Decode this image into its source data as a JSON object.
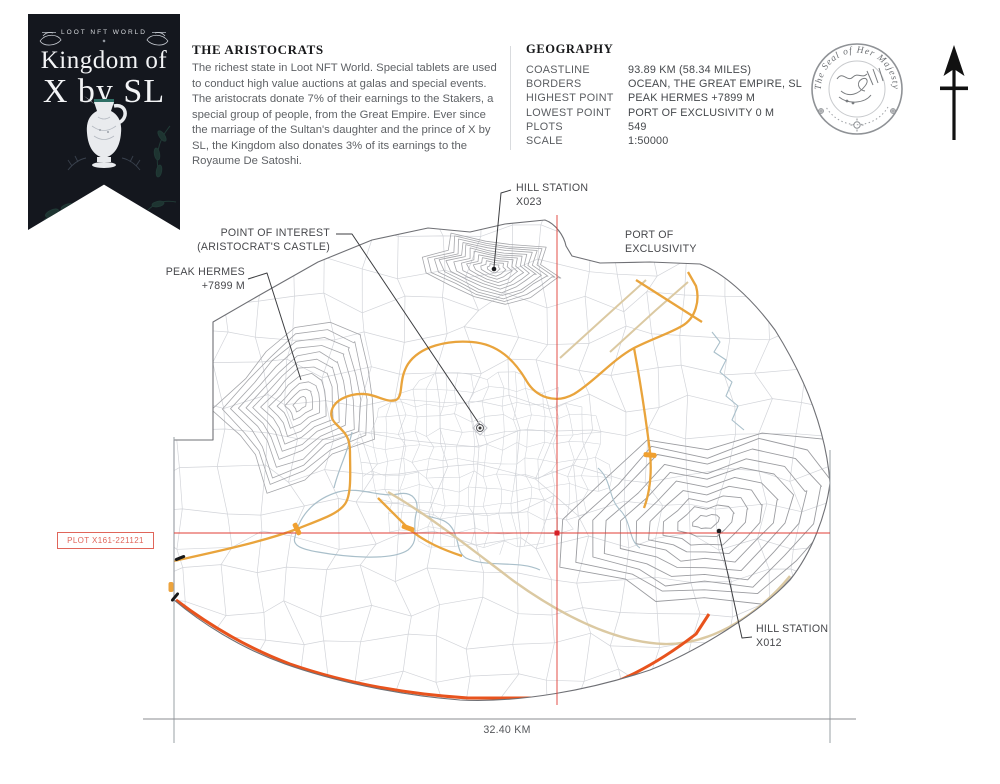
{
  "banner": {
    "kicker": "LOOT NFT WORLD",
    "title_line1": "Kingdom of",
    "title_line2": "X by SL"
  },
  "about": {
    "heading": "THE ARISTOCRATS",
    "body": "The richest state in Loot NFT World. Special tablets are used to conduct high value auctions at galas and special events. The aristocrats donate 7% of their earnings to the Stakers, a special group of people, from the Great Empire. Ever since the marriage of the Sultan's daughter and the prince of X by SL, the Kingdom also donates 3% of its earnings to the Royaume De Satoshi."
  },
  "geography": {
    "heading": "GEOGRAPHY",
    "rows": [
      {
        "label": "COASTLINE",
        "value": "93.89 KM (58.34 MILES)"
      },
      {
        "label": "BORDERS",
        "value": "OCEAN, THE GREAT EMPIRE, SL"
      },
      {
        "label": "HIGHEST POINT",
        "value": "PEAK HERMES +7899 M"
      },
      {
        "label": "LOWEST POINT",
        "value": "PORT OF EXCLUSIVITY 0 M"
      },
      {
        "label": "PLOTS",
        "value": "549"
      },
      {
        "label": "SCALE",
        "value": "1:50000"
      }
    ]
  },
  "seal": {
    "text": "The Seal of Her Majesty"
  },
  "map": {
    "labels": {
      "hill_x023": {
        "line1": "HILL STATION",
        "line2": "X023"
      },
      "poi": {
        "line1": "POINT OF INTEREST",
        "line2": "(ARISTOCRAT'S CASTLE)"
      },
      "port": {
        "line1": "PORT OF",
        "line2": "EXCLUSIVITY"
      },
      "peak": {
        "line1": "PEAK HERMES",
        "line2": "+7899 M"
      },
      "hill_x012": {
        "line1": "HILL STATION",
        "line2": "X012"
      }
    },
    "plot_tag": "PLOT X161-221121",
    "scale_label": "32.40 KM"
  },
  "colors": {
    "banner_bg": "#14171e",
    "road_amber": "#e9a43c",
    "road_tan": "#dbc9a2",
    "coastal_road": "#e8531d",
    "crosshair": "#e03c34",
    "plot_tag": "#e0655a",
    "water": "#a9bfca",
    "coast": "#6f7075",
    "contour": "#a5a6aa",
    "parcel": "#d2d4d9",
    "leader": "#3c3d40"
  }
}
